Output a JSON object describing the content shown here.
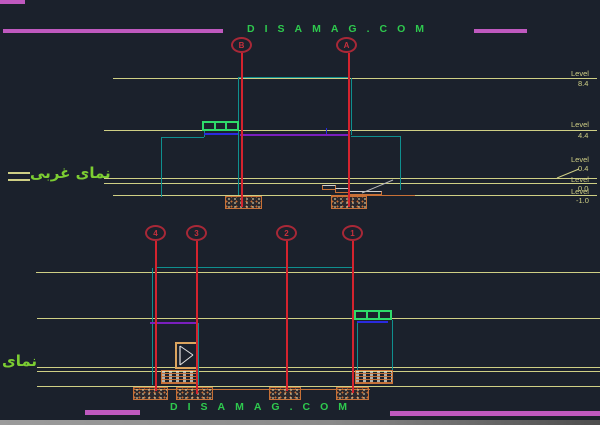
{
  "brand": {
    "top": "DISAMAG.COM",
    "bottom": "DISAMAG.COM"
  },
  "titles": {
    "upper_elevation": "نمای غربی",
    "lower_elevation": "نمای"
  },
  "grid_bubbles": {
    "upper": [
      {
        "label": "B"
      },
      {
        "label": "A"
      }
    ],
    "lower": [
      {
        "label": "4"
      },
      {
        "label": "3"
      },
      {
        "label": "2"
      },
      {
        "label": "1"
      }
    ]
  },
  "levels": {
    "items": [
      {
        "word": "Level",
        "value": "8.4"
      },
      {
        "word": "Level",
        "value": "4.4"
      },
      {
        "word": "Level",
        "value": "0.4"
      },
      {
        "word": "Level",
        "value": "0.0"
      },
      {
        "word": "Level",
        "value": "-1.0"
      }
    ]
  },
  "colors": {
    "bg": "#1b212c",
    "yellow": "#cfcf85",
    "teal": "#0f8f8f",
    "red": "#d4232e",
    "orange": "#c87137",
    "purple": "#7a1fbe",
    "blue": "#2a2adf",
    "magenta": "#bf59bf",
    "green": "#2ec94e",
    "fagreen": "#7ccd32"
  }
}
